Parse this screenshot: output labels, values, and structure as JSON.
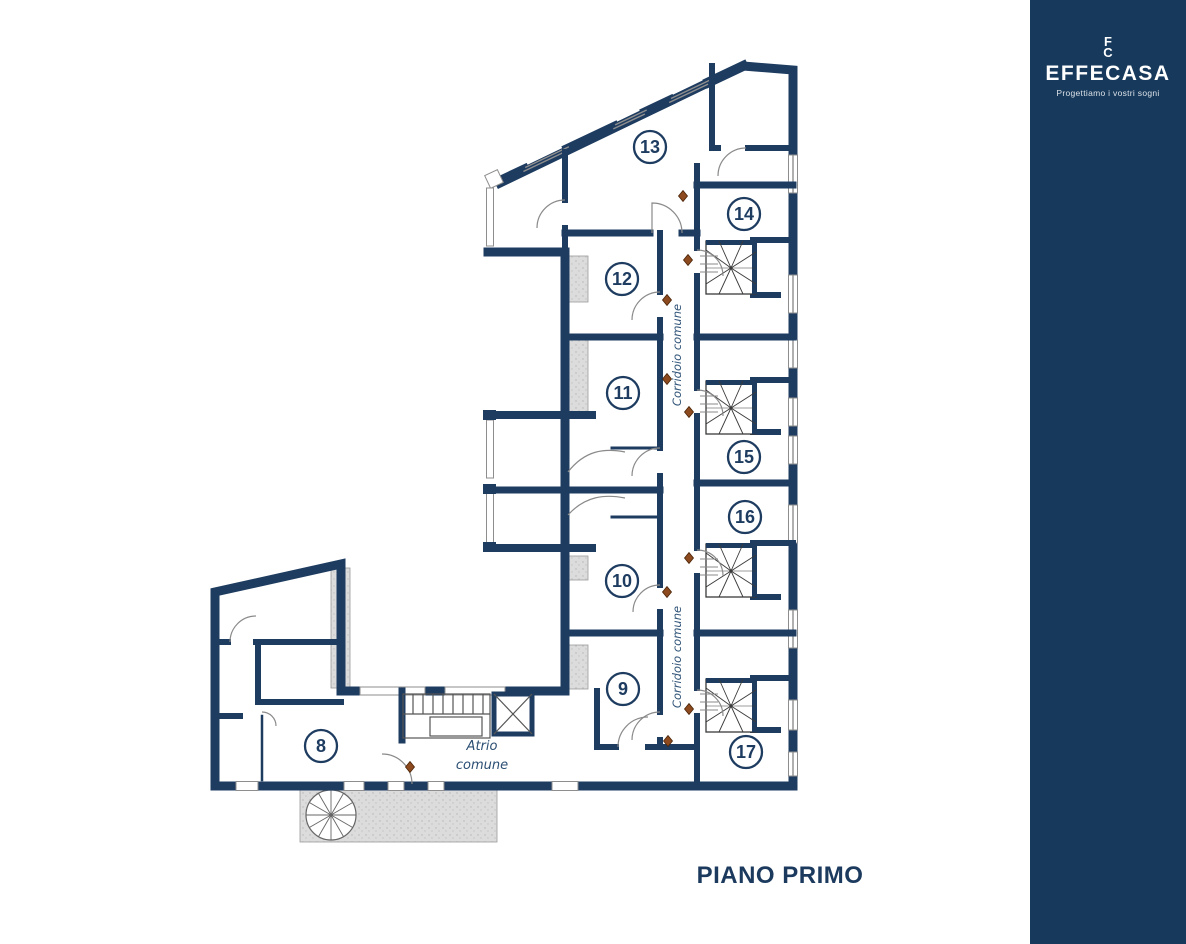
{
  "title": "PIANO PRIMO",
  "plan": {
    "rooms": [
      {
        "label": "8",
        "x": 321,
        "y": 746
      },
      {
        "label": "9",
        "x": 623,
        "y": 689
      },
      {
        "label": "10",
        "x": 622,
        "y": 581
      },
      {
        "label": "11",
        "x": 623,
        "y": 393
      },
      {
        "label": "12",
        "x": 622,
        "y": 279
      },
      {
        "label": "13",
        "x": 650,
        "y": 147
      },
      {
        "label": "14",
        "x": 744,
        "y": 214
      },
      {
        "label": "15",
        "x": 744,
        "y": 457
      },
      {
        "label": "16",
        "x": 745,
        "y": 517
      },
      {
        "label": "17",
        "x": 746,
        "y": 752
      }
    ],
    "corridor_labels": [
      {
        "text": "Corridoio comune",
        "x": 681,
        "y": 355
      },
      {
        "text": "Corridoio comune",
        "x": 681,
        "y": 657
      }
    ],
    "atrium_label": {
      "line1": "Atrio",
      "line2": "comune",
      "x": 482,
      "y": 750
    },
    "colors": {
      "wall": "#1e3c60",
      "window_line": "#8e8e8e",
      "door_marker": "#8d4a1e",
      "hatch_gray": "#d8d8d8",
      "label_navy": "#1b3a5e"
    }
  },
  "sidebar": {
    "background": "#16395c",
    "logo_key_top": "F",
    "logo_key_bottom": "C",
    "brand": "EFFECASA",
    "tagline": "Progettiamo i vostri sogni",
    "compass_letter": "N",
    "wordmark": "the garage",
    "wordmark_sub": "abitare urbano"
  },
  "icons": {
    "logo_mark": "key-icon",
    "compass": "compass-icon",
    "door_markers": "door-marker-icon",
    "stairs": "stair-icon",
    "spiral_stair": "spiral-stair-icon",
    "elevator": "elevator-icon"
  }
}
